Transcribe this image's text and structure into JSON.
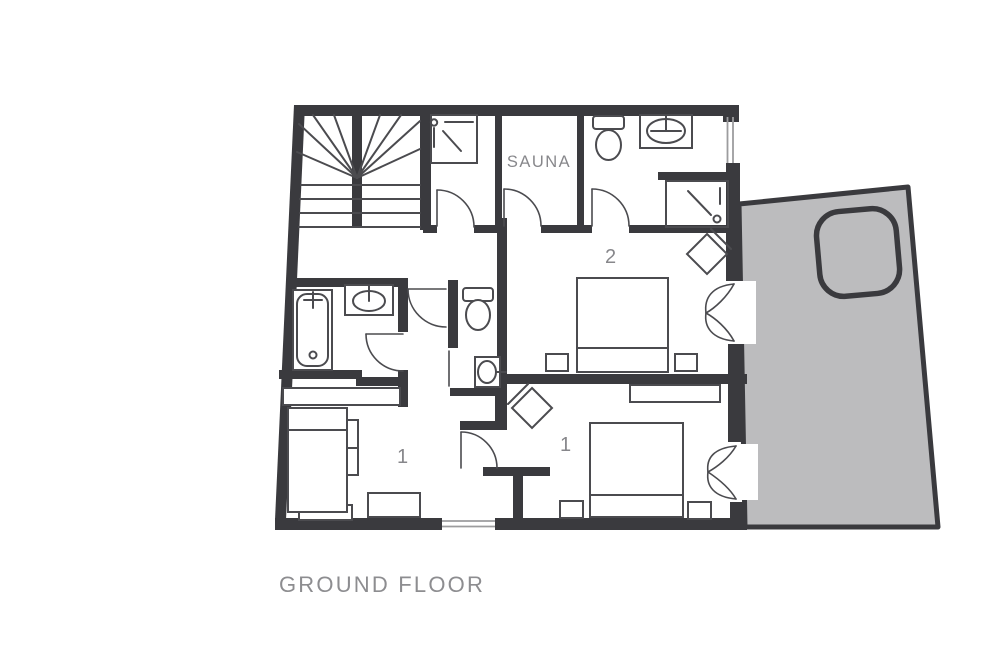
{
  "plan": {
    "title": "GROUND FLOOR",
    "rooms": {
      "sauna": "SAUNA",
      "bedroom2": "2",
      "bedroom1": "1",
      "bedroom1_lounge": "1"
    },
    "fixtures": [
      "staircase",
      "shower",
      "sauna",
      "toilet",
      "sink",
      "bathtub",
      "double-bed",
      "nightstand",
      "dresser",
      "sofa-bed",
      "side-table",
      "stove",
      "french-doors",
      "door",
      "window",
      "terrace",
      "hot-tub"
    ]
  },
  "colors": {
    "wall": "#3a3a3e",
    "line": "#4b4b4f",
    "furniture": "#4b4b4f",
    "label": "#87878b",
    "title": "#8d8d90",
    "terrace_fill": "#bcbcbe",
    "window_line": "#9c9c9e",
    "background": "#ffffff"
  }
}
